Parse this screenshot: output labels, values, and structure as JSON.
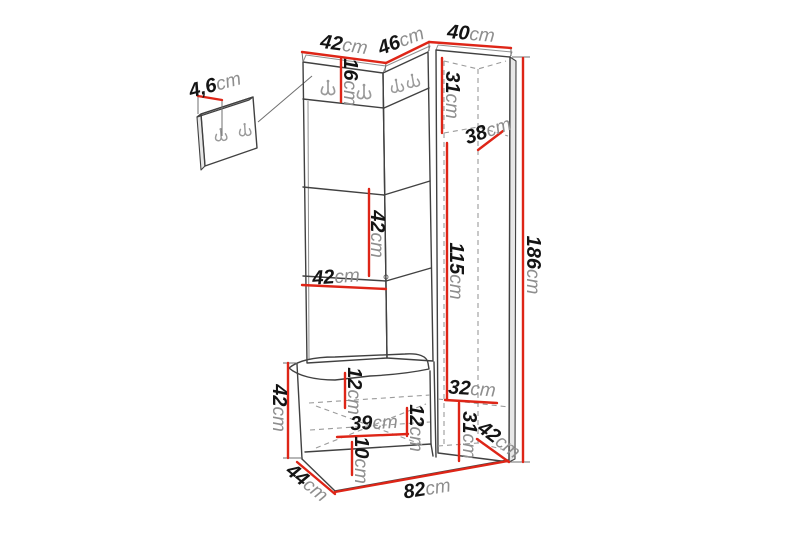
{
  "diagram": {
    "title": "hallway-unit-dimension-diagram",
    "unit": "cm",
    "colors": {
      "dimension_line": "#de2517",
      "furniture_line": "#414141",
      "hidden_line_dashed": "#9b9b9b",
      "label_number": "#141414",
      "label_unit": "#8e8e8e",
      "background": "#ffffff"
    },
    "icons": {
      "coat_hook": "double-j-hook-icon"
    },
    "dimensions": {
      "top_left_width": "42",
      "top_corner_width": "46",
      "top_right_width": "40",
      "wall_panel_thickness": "4,6",
      "hook_panel_height": "16",
      "upper_right_section_height": "31",
      "upper_right_depth": "38",
      "shelf_section_height": "42",
      "shelf_width": "42",
      "hanging_section_height": "115",
      "overall_height": "186",
      "lower_right_shelf_width": "32",
      "bench_top_gap_height": "12",
      "drawer_width": "39",
      "drawer_height": "12",
      "plinth_height": "10",
      "lower_right_section_height": "31",
      "lower_right_depth": "42",
      "bench_height": "42",
      "bench_depth": "44",
      "overall_width": "82"
    }
  }
}
